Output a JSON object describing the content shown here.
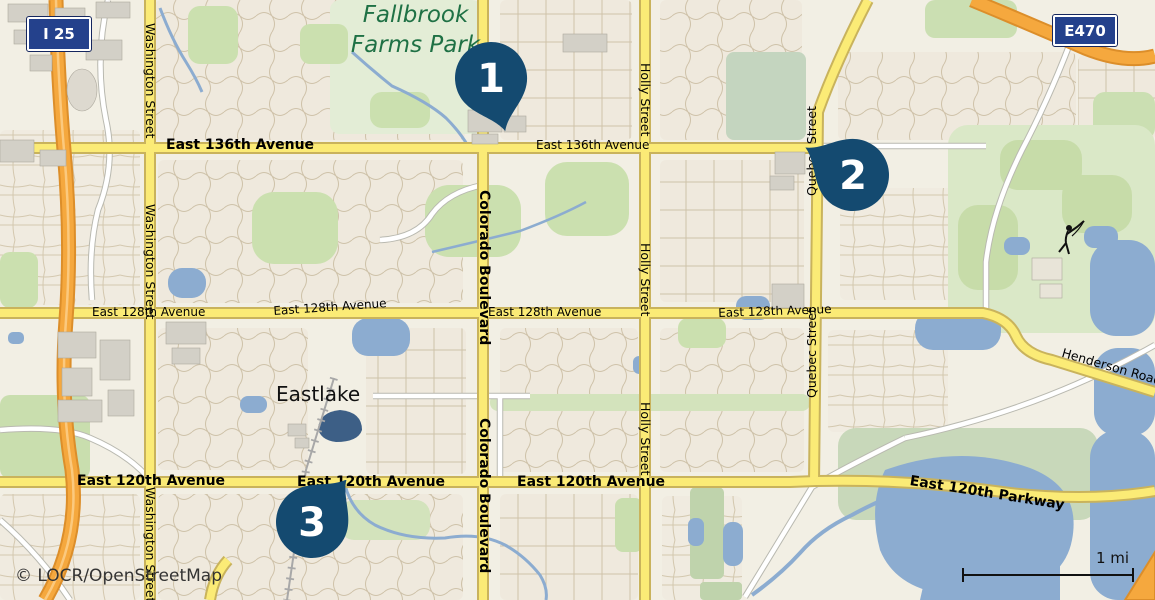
{
  "attribution": "© LOCR/OpenStreetMap",
  "scale": {
    "label": "1 mi"
  },
  "place_labels": {
    "park_line1": "Fallbrook",
    "park_line2": "Farms Park",
    "town": "Eastlake"
  },
  "shields": [
    {
      "id": "i25",
      "label": "I 25"
    },
    {
      "id": "e470",
      "label": "E470"
    }
  ],
  "road_labels": {
    "e136": "East 136th Avenue",
    "e128": "East 128th Avenue",
    "e120": "East 120th Avenue",
    "e120_parkway": "East 120th Parkway",
    "washington": "Washington Street",
    "colorado": "Colorado Boulevard",
    "holly": "Holly Street",
    "quebec": "Quebec Street",
    "henderson": "Henderson Road"
  },
  "markers": [
    {
      "label": "1",
      "x": 491,
      "y": 78
    },
    {
      "label": "2",
      "x": 853,
      "y": 175
    },
    {
      "label": "3",
      "x": 312,
      "y": 522
    }
  ],
  "colors": {
    "marker": "#144A70",
    "shield_blue": "#24418C",
    "road_yellow": "#FBEB76",
    "highway_orange": "#F5A83E",
    "water": "#8CACD0",
    "dark_lake": "#3D5F86",
    "park_green": "#CBE0AF",
    "park_text_green": "#1F7145",
    "background": "#F2EFE4"
  }
}
